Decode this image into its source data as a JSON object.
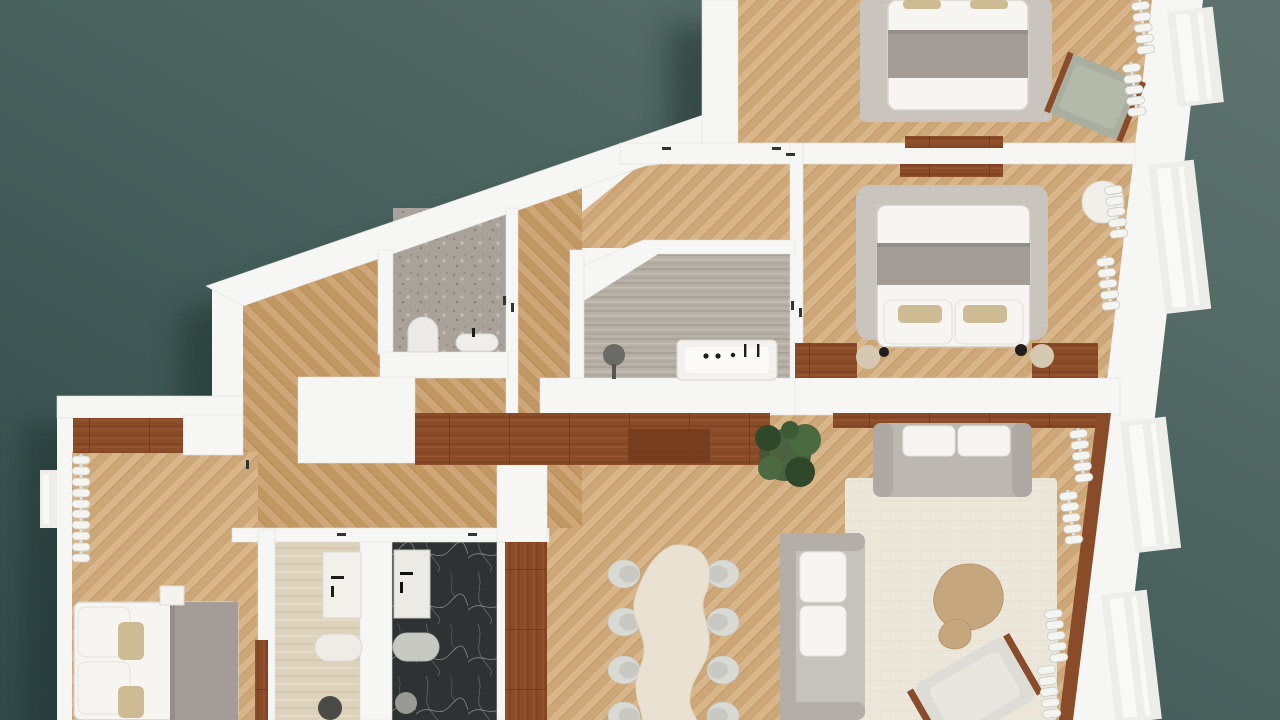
{
  "title": "3d-apartment-floor-plan",
  "palette": {
    "teal_top": "#5f736e",
    "teal_mid": "#4a635f",
    "teal_dark": "#324b49",
    "shadow_teal": "#1b302f",
    "wall": "#f6f6f4",
    "wall_shade": "#e7e7e3",
    "oak_a": "#d8b68a",
    "oak_b": "#cda777",
    "oak_line": "#bd9565",
    "warm_a": "#cfa677",
    "warm_b": "#c29862",
    "warm_line": "#b28a57",
    "wood_dark": "#8a4b28",
    "wood_dark2": "#743c1e",
    "wood_mid": "#a46a3c",
    "travertine": "#b7b1a7",
    "travertine_dark": "#a8a298",
    "travertine_light": "#c3bdb3",
    "terrazzo": "#a8a29a",
    "beige_stone": "#ddd2bb",
    "marble_dark": "#2e3233",
    "marble_vein": "#aeb4b2",
    "rug_gray": "#c9c5be",
    "rug_cream": "#ebe7db",
    "sofa_gray": "#bcb8b1",
    "sofa_light": "#c6c3bc",
    "linen_white": "#f6f5f1",
    "blanket_gray": "#a49d97",
    "sage_green": "#a9afa0",
    "plant_green": "#3d5a37",
    "plant_green_dark": "#2e4829",
    "plant_green_light": "#4b6a41",
    "accent_pillow": "#cdbb94",
    "table_cream": "#e9e2d2",
    "chair_shell": "#dadad5",
    "chair_seat": "#c9c9c3",
    "coffee_wood": "#c6a67c",
    "fixture_black": "#222222",
    "window_box": "#ededea",
    "window_inner": "#f9f9f7"
  },
  "rooms": [
    {
      "id": "bedroom-1",
      "label": "bedroom-top",
      "furniture": [
        "double-bed",
        "gray-area-rug",
        "sage-lounge-chair",
        "radiators",
        "headboard-console"
      ]
    },
    {
      "id": "bedroom-2",
      "label": "bedroom-right",
      "furniture": [
        "double-bed-with-pillows",
        "boucle-headboard-rug",
        "round-side-table",
        "nightstands-with-lamps",
        "wood-benches",
        "radiator"
      ]
    },
    {
      "id": "main-bathroom",
      "label": "travertine-bathroom",
      "furniture": [
        "bathtub",
        "black-fixtures",
        "round-basin-stool"
      ]
    },
    {
      "id": "powder-room",
      "label": "terrazzo-wc",
      "furniture": [
        "toilet",
        "wall-hung-sink"
      ]
    },
    {
      "id": "entry-hall",
      "label": "hallway",
      "furniture": [
        "structural-core",
        "long-wood-console"
      ]
    },
    {
      "id": "bedroom-3",
      "label": "bedroom-left",
      "furniture": [
        "double-bed",
        "wardrobe-strip",
        "towel-radiators",
        "white-nightstand"
      ]
    },
    {
      "id": "bathroom-2",
      "label": "beige-stone-bathroom",
      "furniture": [
        "vanity-sink",
        "capsule-bathtub",
        "toilet"
      ]
    },
    {
      "id": "bathroom-3",
      "label": "dark-marble-bathroom",
      "furniture": [
        "vanity-sink",
        "capsule-bathtub",
        "toilet"
      ]
    },
    {
      "id": "dining-area",
      "label": "dining",
      "furniture": [
        "organic-shaped-table",
        "eight-chairs",
        "potted-plant",
        "sideboard"
      ]
    },
    {
      "id": "living-room",
      "label": "living",
      "furniture": [
        "two-sofas",
        "fringe-pillows",
        "cream-rug",
        "kidney-coffee-tables",
        "wood-frame-armchair",
        "radiators",
        "window-sill-band"
      ]
    }
  ]
}
